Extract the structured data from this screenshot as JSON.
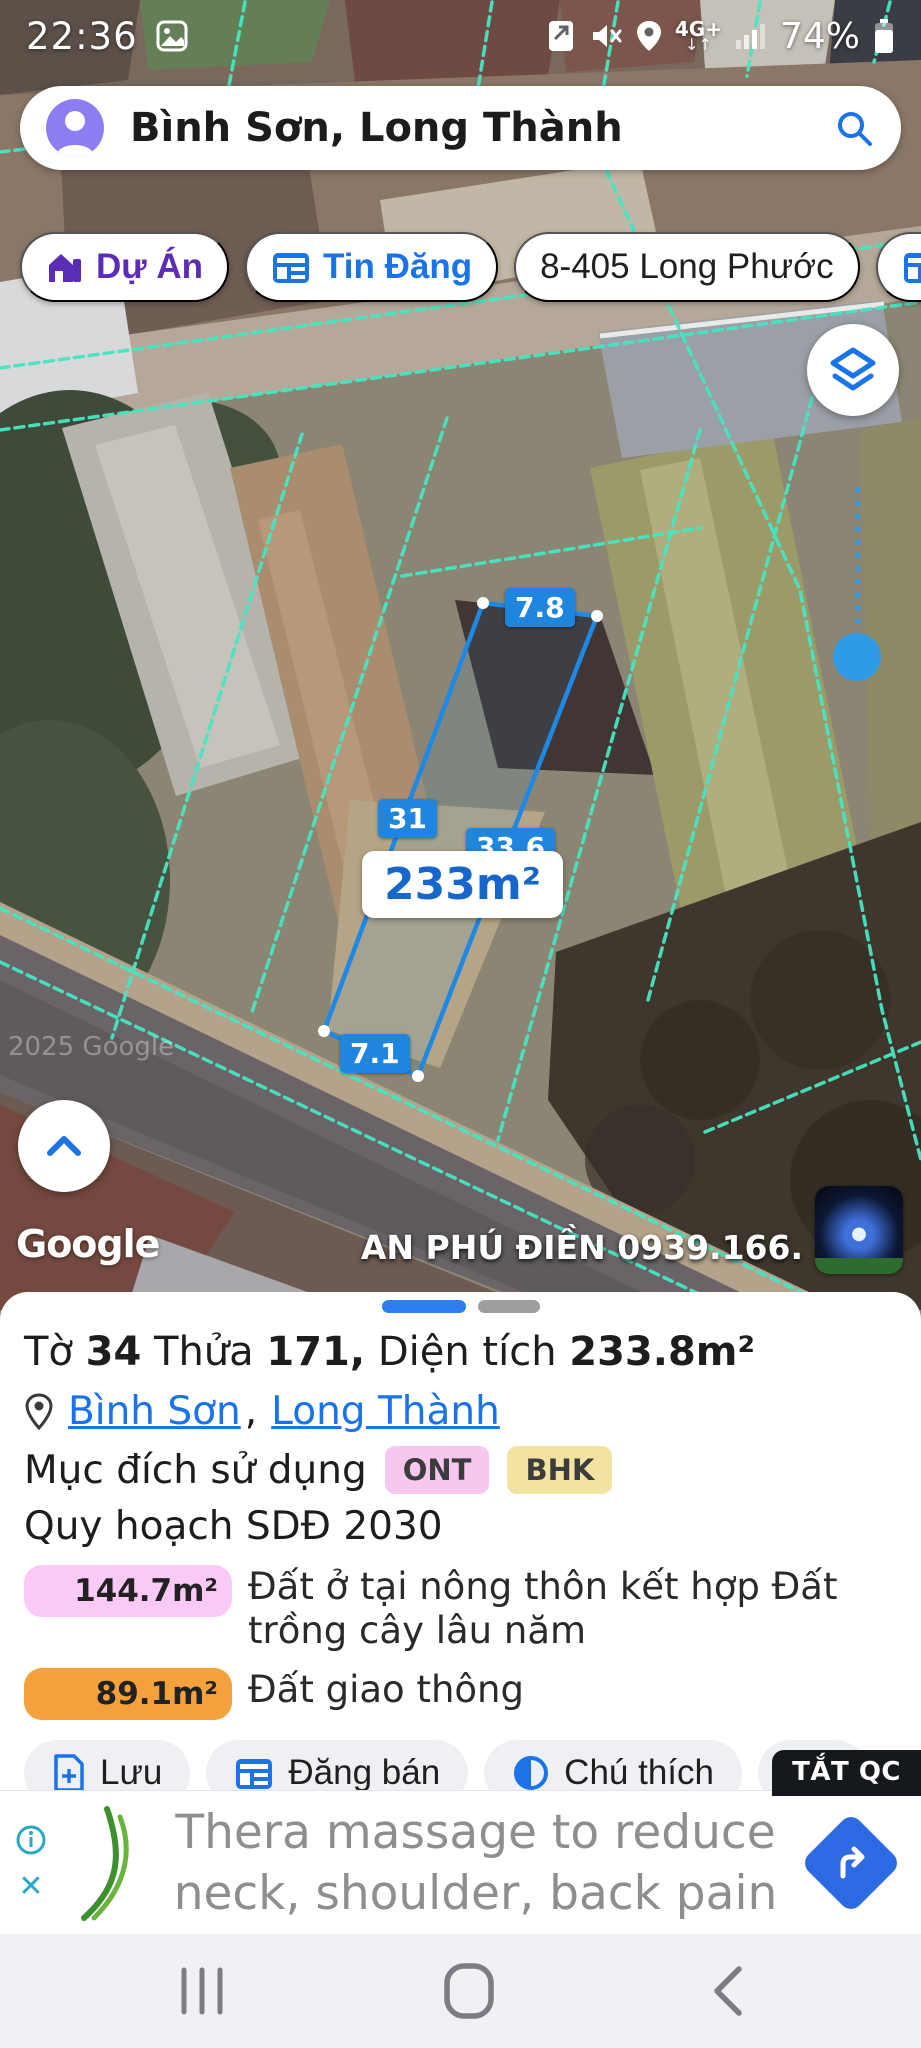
{
  "status_bar": {
    "time": "22:36",
    "battery_percent": "74%",
    "network": "4G+"
  },
  "search": {
    "query": "Bình Sơn, Long Thành"
  },
  "chips": {
    "du_an": "Dự Án",
    "tin_dang": "Tin Đăng",
    "address": "8-405 Long Phước",
    "more": "1."
  },
  "map": {
    "accent_teal": "#47e5c2",
    "accent_blue": "#1e88e5",
    "parcel": {
      "edge_top": "7.8",
      "edge_left": "31",
      "edge_right": "33.6",
      "edge_bottom": "7.1",
      "area_label": "233m²"
    },
    "imagery_credit": "2025 Google",
    "watermark": "Google",
    "agent_overlay": "AN PHÚ ĐIỀN 0939.166."
  },
  "sheet": {
    "title": {
      "w1": "Tờ",
      "n1": "34",
      "w2": "Thửa",
      "n2": "171,",
      "w3": "Diện tích",
      "n3": "233.8m²"
    },
    "location": {
      "link1": "Bình Sơn",
      "sep": ",",
      "link2": "Long Thành"
    },
    "purpose_label": "Mục đích sử dụng",
    "purpose_badges": {
      "b1": "ONT",
      "b2": "BHK",
      "b1_color": "#f7c7f0",
      "b2_color": "#f2e3a2"
    },
    "plan_label": "Quy hoạch SDĐ 2030",
    "land_uses": [
      {
        "area": "144.7m²",
        "desc": "Đất ở tại nông thôn kết hợp Đất trồng cây lâu năm",
        "color": "#fbc9f6"
      },
      {
        "area": "89.1m²",
        "desc": "Đất giao thông",
        "color": "#f2a13c"
      }
    ],
    "actions": {
      "save": "Lưu",
      "post": "Đăng bán",
      "legend": "Chú thích"
    }
  },
  "ad": {
    "dismiss_label": "TẮT QC",
    "line1": "Thera massage to reduce",
    "line2": "neck, shoulder, back pain"
  }
}
